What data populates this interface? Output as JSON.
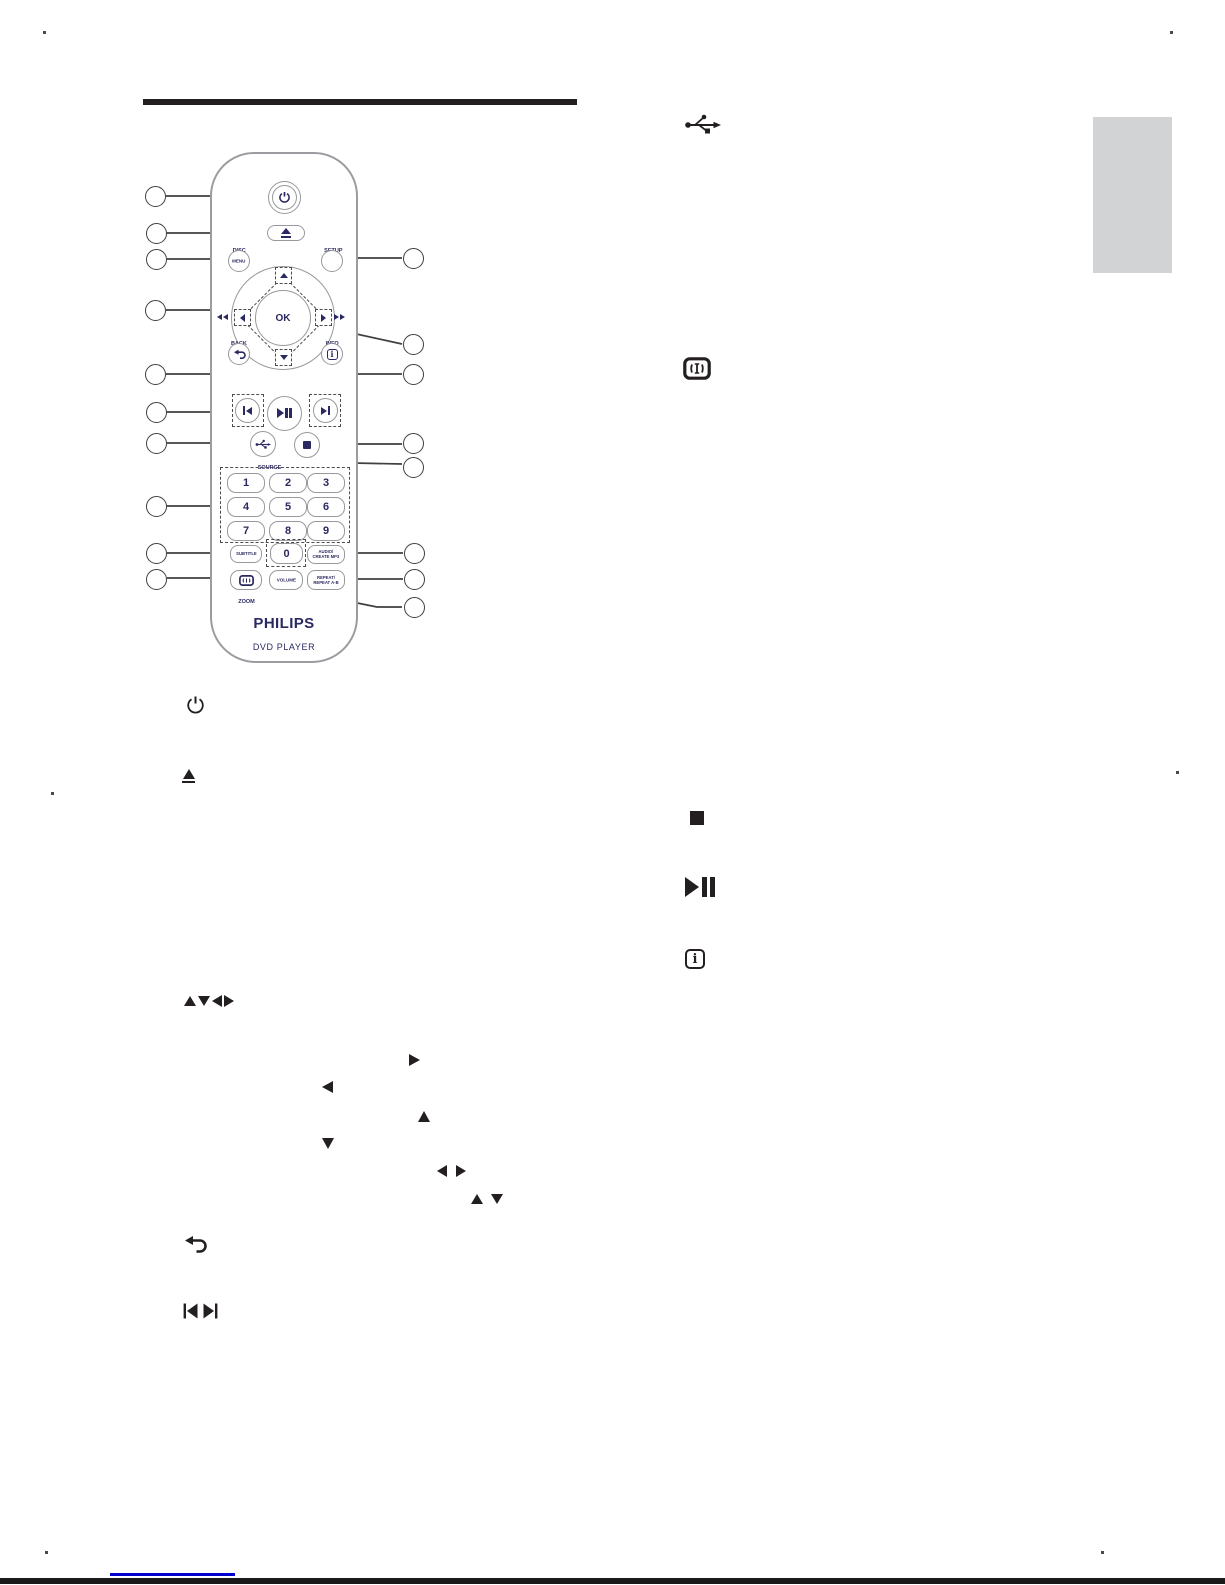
{
  "remote": {
    "brand": "PHILIPS",
    "device": "DVD PLAYER",
    "buttons": {
      "disc": "DISC",
      "menu": "MENU",
      "setup": "SETUP",
      "ok": "OK",
      "back": "BACK",
      "info": "INFO",
      "info_glyph": "i",
      "source": "SOURCE",
      "digits": [
        "1",
        "2",
        "3",
        "4",
        "5",
        "6",
        "7",
        "8",
        "9"
      ],
      "zero": "0",
      "subtitle": "SUBTITLE",
      "audio_line1": "AUDIO/",
      "audio_line2": "CREATE MP3",
      "zoom": "ZOOM",
      "volume": "VOLUME",
      "repeat_line1": "REPEAT/",
      "repeat_line2": "REPEAT A-B"
    }
  },
  "right_column_icons": [
    "usb-icon",
    "screen-fit-icon",
    "stop-icon",
    "play-pause-icon",
    "info-icon"
  ],
  "left_list_icons": [
    "power-icon",
    "eject-icon",
    "nav-arrows-icon",
    "right-arrow-icon",
    "left-arrow-icon",
    "up-arrow-icon",
    "down-arrow-icon",
    "left-right-arrows-icon",
    "up-down-arrows-icon",
    "back-icon",
    "prev-next-icon"
  ],
  "colors": {
    "label_navy": "#2a2961",
    "outline_gray": "#97999c",
    "callout_dark": "#3f3f41",
    "icon_black": "#231f20",
    "tab_gray": "#d2d3d5",
    "link_blue": "#0000cf"
  }
}
